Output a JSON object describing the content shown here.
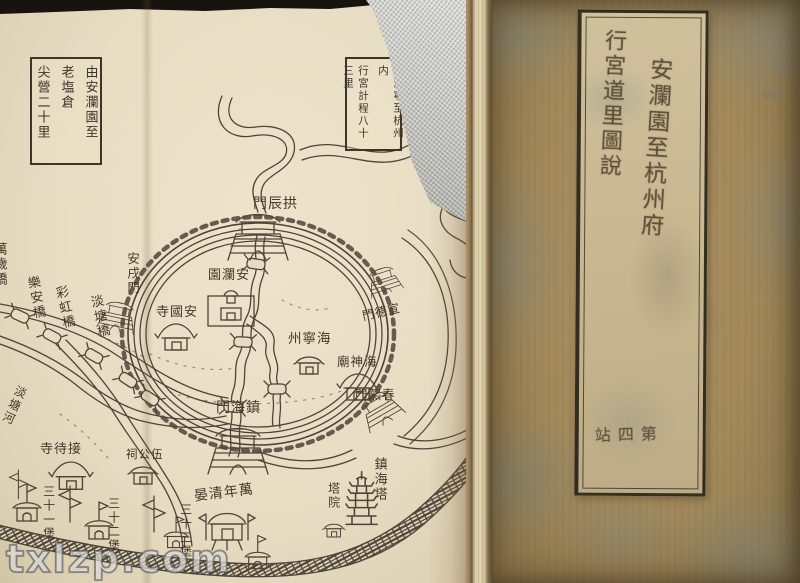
{
  "watermark": {
    "text": "txlzp.com"
  },
  "map": {
    "box_left": {
      "col1": "由安瀾園至",
      "col2": "老塩倉",
      "col3": "尖營二十里"
    },
    "box_right": {
      "col1": "自海寧至杭州内",
      "col2": "行宮計程八十三里"
    },
    "labels": {
      "gate_north": "門辰拱",
      "gate_west": "安戌門",
      "garden_anlan": "園瀾安",
      "temple_anguo": "寺國安",
      "prefecture_haining": "州寧海",
      "temple_haishen": "廟神海",
      "gate_xuande": "門德宣",
      "gate_chunxi": "門熙春",
      "gate_zhenhai": "門海鎮",
      "bridge_lean": "樂安橋",
      "bridge_caihong": "彩虹橋",
      "bridge_dantang": "淡塘橋",
      "bridge_wansui": "萬歲橋",
      "river_dantang": "淡塘河",
      "temple_jiedai": "寺待接",
      "shrine_wugong": "祠公伍",
      "fort_31": "三十一堡",
      "fort_32": "三十二堡",
      "fort_33": "三十三堡",
      "arch_wannian": "晏清年萬",
      "pagoda_zhenhai": "鎮海塔",
      "pagoda_yard": "塔院"
    }
  },
  "cover": {
    "title_right_column": "安瀾園至杭州府",
    "title_left_column": "行宮道里圖說",
    "volume_mark": "站四第",
    "pencil_notes": {
      "line1": "82",
      "line2": "gm"
    }
  },
  "colors": {
    "paper": "#e8ddc3",
    "ink": "#4f4438",
    "cover": "#a2895b",
    "label_paper": "#c7b790"
  }
}
